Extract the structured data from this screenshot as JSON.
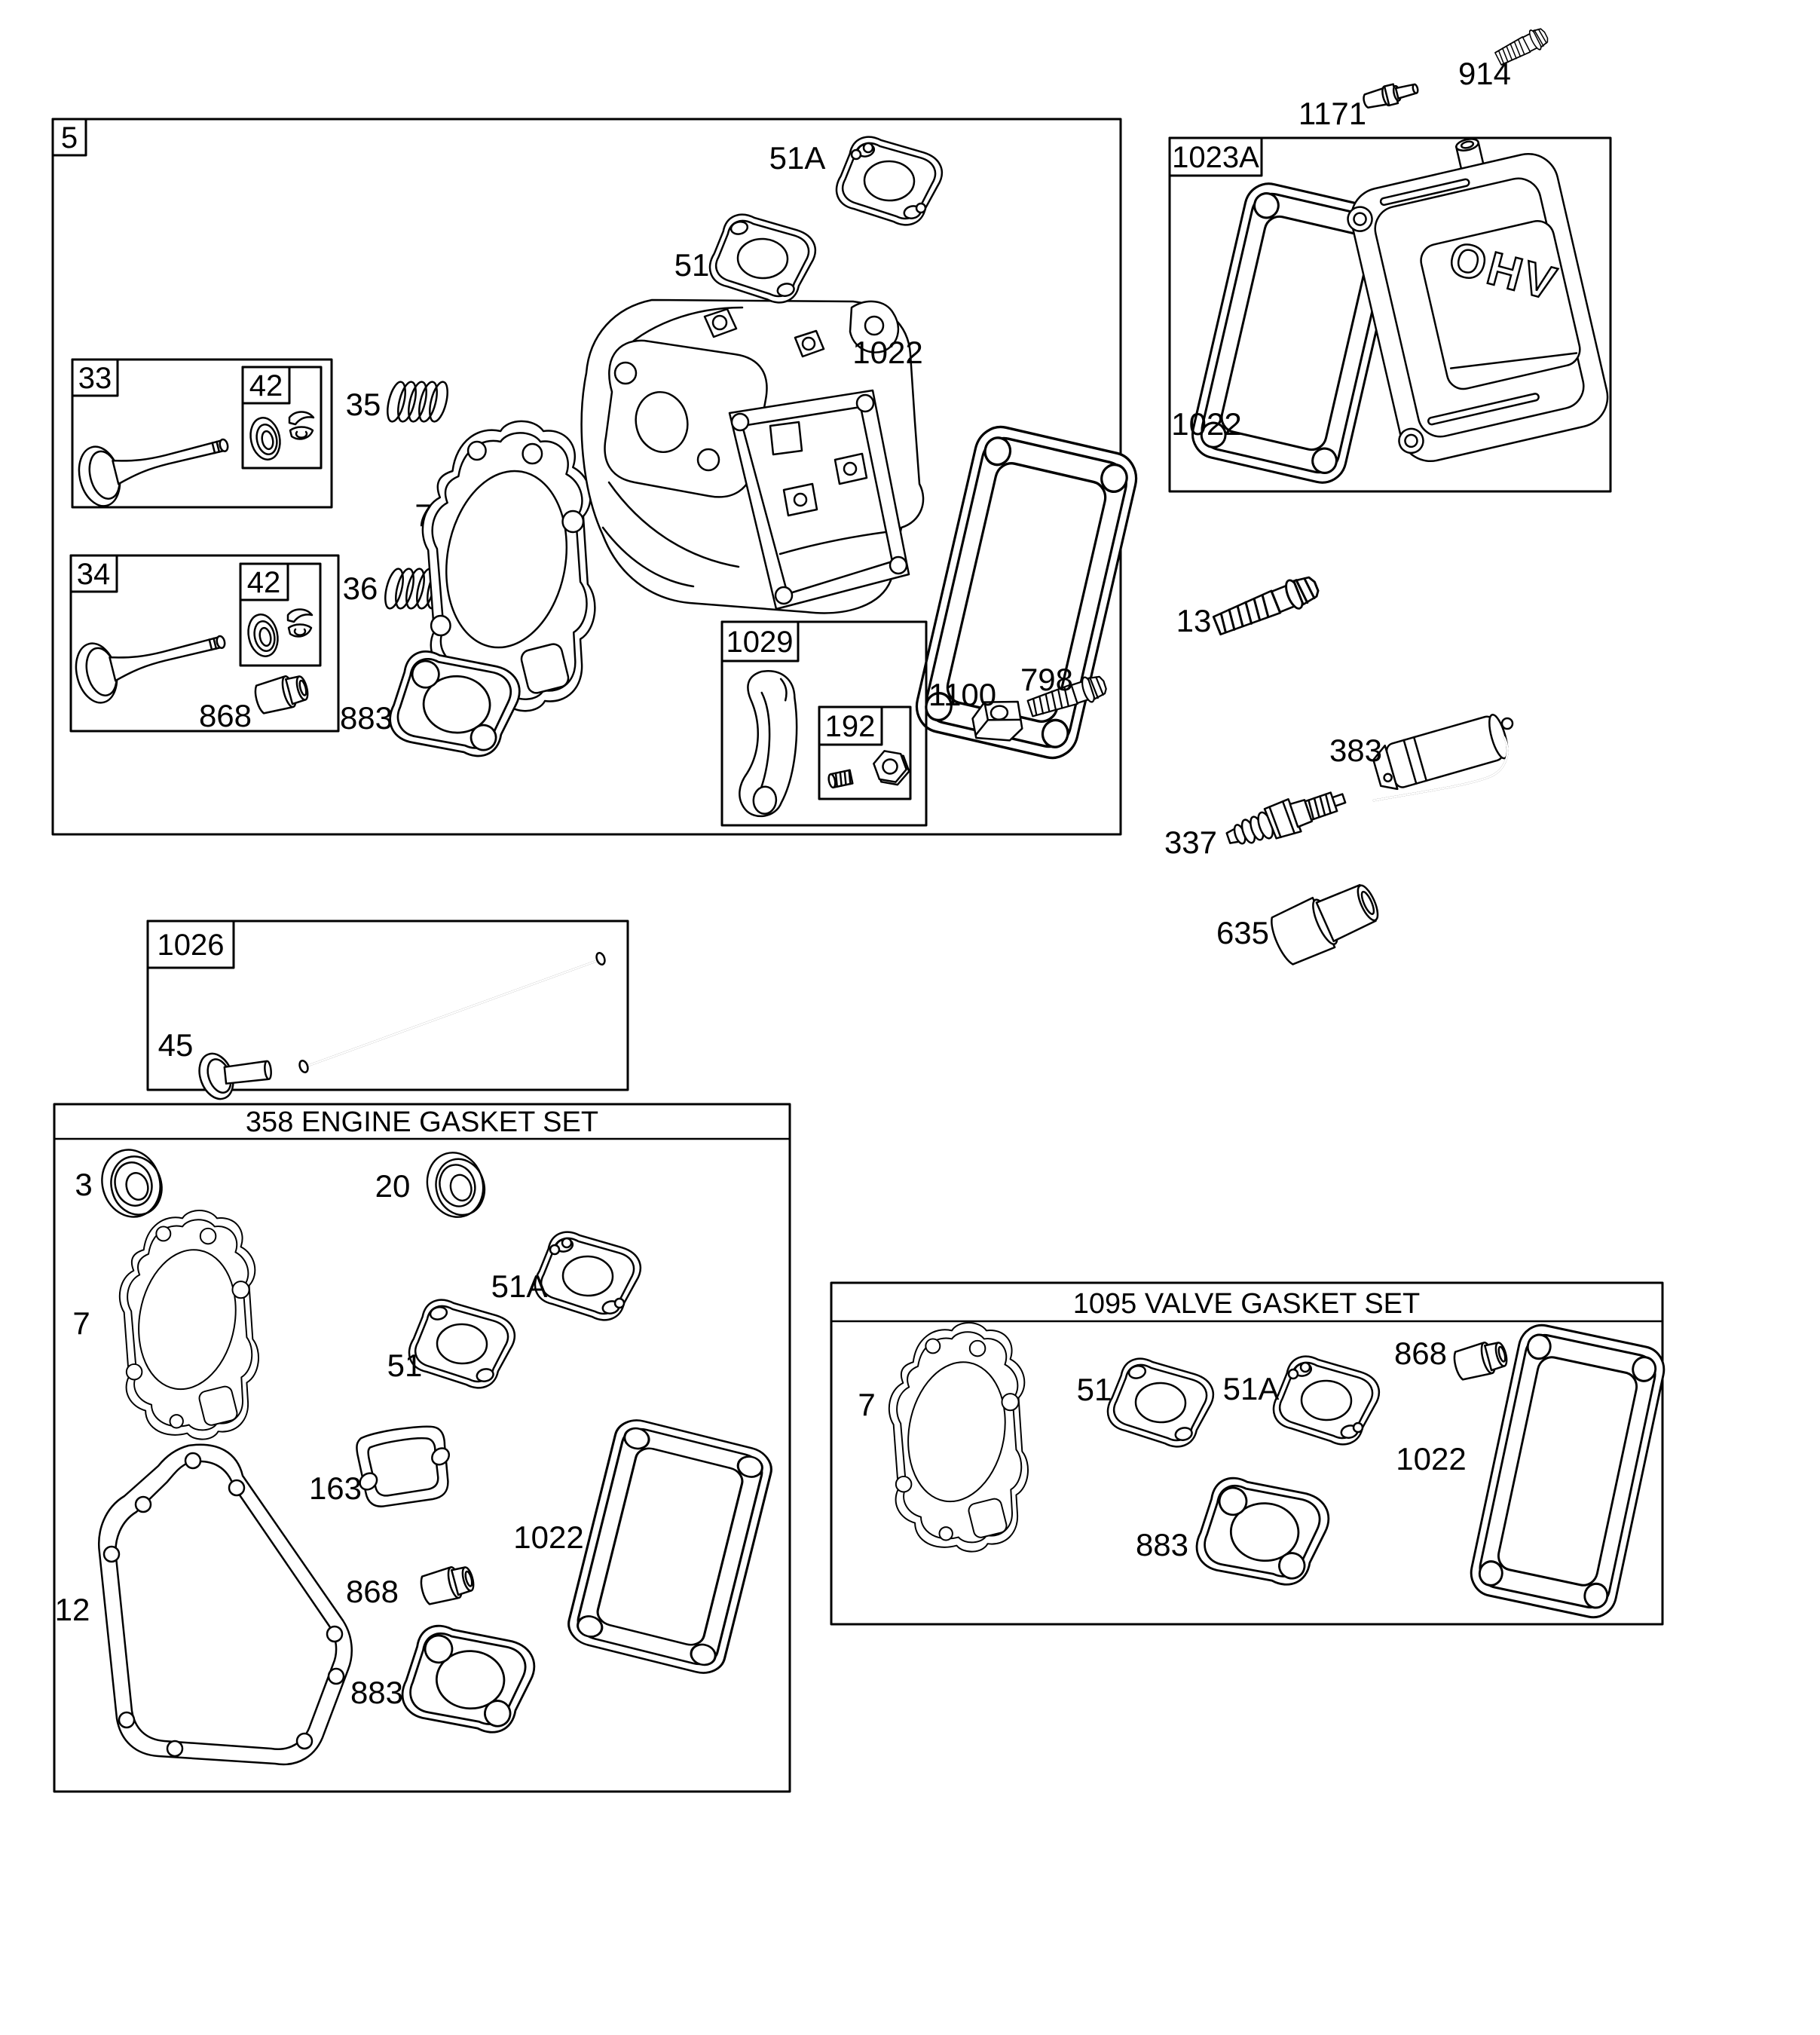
{
  "figure": {
    "background": "#ffffff",
    "line_color": "#000000",
    "description": "Exploded engine parts diagram - cylinder head, valves, rocker parts and gasket sets"
  },
  "head_group": {
    "ref": "5",
    "carb_gasket_upper": "51A",
    "carb_gasket_lower": "51",
    "valve_cover_gasket": "1022",
    "head_gasket": "7",
    "intake_spring": "35",
    "exhaust_spring": "36",
    "valve_guide_seal": "868",
    "exhaust_gasket": "883",
    "intake_valve_box": {
      "ref": "33",
      "seal_kit": "42"
    },
    "exhaust_valve_box": {
      "ref": "34",
      "seal_kit": "42"
    },
    "rocker_box": {
      "ref": "1029",
      "hardware": "192"
    },
    "rocker_pivot": "1100",
    "rocker_screw": "798"
  },
  "valve_cover_group": {
    "ref": "1023A",
    "gasket": "1022",
    "cover_emblem": "OHV"
  },
  "loose_parts": {
    "cover_screw": "914",
    "breather_valve": "1171",
    "head_bolt": "13",
    "breather_tube": "383",
    "spark_plug": "337",
    "spark_plug_boot": "635"
  },
  "pushrod_group": {
    "ref": "1026",
    "tappet": "45"
  },
  "engine_gasket_set": {
    "title": "358 ENGINE GASKET SET",
    "magneto_seal": "3",
    "pto_seal": "20",
    "head_gasket": "7",
    "carb_gasket_upper": "51A",
    "carb_gasket_lower": "51",
    "intake_gasket": "163",
    "valve_cover_gasket": "1022",
    "valve_guide_seal": "868",
    "crankcase_gasket": "12",
    "exhaust_gasket": "883"
  },
  "valve_gasket_set": {
    "title": "1095 VALVE GASKET SET",
    "head_gasket": "7",
    "carb_gasket_lower": "51",
    "carb_gasket_upper": "51A",
    "valve_guide_seal": "868",
    "valve_cover_gasket": "1022",
    "exhaust_gasket": "883"
  }
}
